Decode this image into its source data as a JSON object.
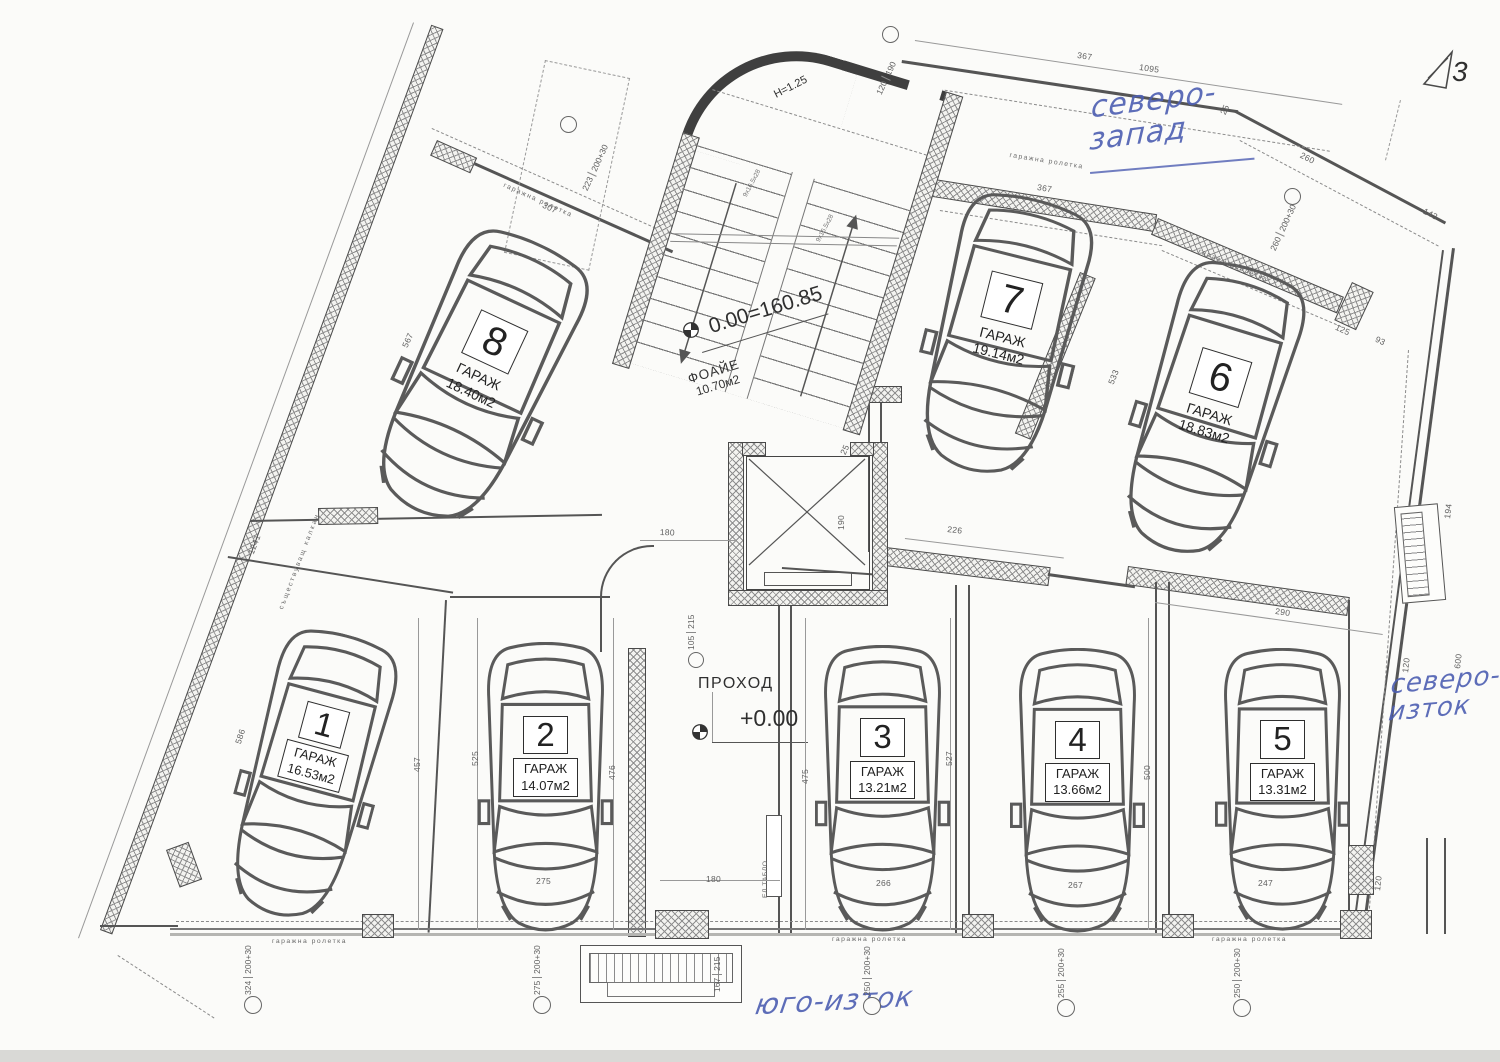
{
  "levels": {
    "foyer": "0.00=160.85",
    "passage": "+0.00"
  },
  "rooms": {
    "foyer_name": "ФОАЙЕ",
    "foyer_area": "10.70м2",
    "passage_name": "ПРОХОД"
  },
  "garages": [
    {
      "num": "1",
      "name": "ГАРАЖ",
      "area": "16.53м2"
    },
    {
      "num": "2",
      "name": "ГАРАЖ",
      "area": "14.07м2"
    },
    {
      "num": "3",
      "name": "ГАРАЖ",
      "area": "13.21м2"
    },
    {
      "num": "4",
      "name": "ГАРАЖ",
      "area": "13.66м2"
    },
    {
      "num": "5",
      "name": "ГАРАЖ",
      "area": "13.31м2"
    },
    {
      "num": "6",
      "name": "ГАРАЖ",
      "area": "18.83м2"
    },
    {
      "num": "7",
      "name": "ГАРАЖ",
      "area": "19.14м2"
    },
    {
      "num": "8",
      "name": "ГАРАЖ",
      "area": "18.40м2"
    }
  ],
  "handwritten": {
    "nw1": "северо-",
    "nw2": "запад",
    "ne1": "северо-",
    "ne2": "изток",
    "se": "юго-изток"
  },
  "labels": {
    "roller": "гаражна ролетка",
    "party_wall": "съществуващ калкан",
    "panel": "ЕЛ.ТАБЛО",
    "stair_note": "H=1.25",
    "stair_steps": "9x16.5x28",
    "section_mark": "3"
  },
  "ink_colors": {
    "print": "#4a4a4a",
    "handwriting": "#4d5eb2"
  },
  "dims": [
    "307",
    "567",
    "1241",
    "586",
    "457",
    "525",
    "476",
    "475",
    "527",
    "500",
    "533",
    "226",
    "290",
    "180",
    "105",
    "215",
    "180",
    "275",
    "266",
    "267",
    "247",
    "324",
    "200+30",
    "275",
    "200+30",
    "167",
    "215",
    "250",
    "200+30",
    "255",
    "200+30",
    "250",
    "200+30",
    "367",
    "1095",
    "25",
    "260",
    "143",
    "367",
    "260",
    "200+30",
    "223",
    "200+30",
    "120",
    "190",
    "125",
    "93",
    "25",
    "190",
    "120",
    "600",
    "194",
    "120"
  ]
}
